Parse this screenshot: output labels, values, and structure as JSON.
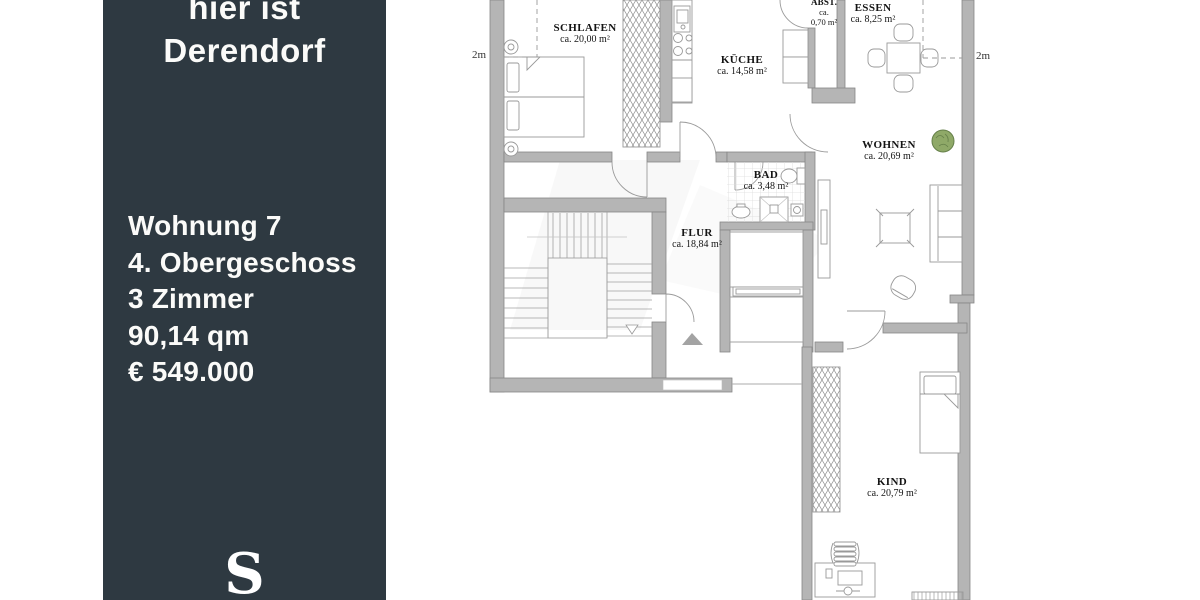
{
  "sidebar": {
    "background_color": "#2e3941",
    "text_color": "#fbfbf9",
    "tagline_line1": "hier ist",
    "tagline_line2": "Derendorf",
    "details": {
      "unit": "Wohnung 7",
      "floor": "4. Obergeschoss",
      "rooms_count": "3 Zimmer",
      "living_space": "90,14 qm",
      "price": "€ 549.000"
    },
    "logo_letter": "S"
  },
  "floorplan": {
    "rooms": [
      {
        "name": "SCHLAFEN",
        "area": "ca. 20,00 m²"
      },
      {
        "name": "KÜCHE",
        "area": "ca. 14,58 m²"
      },
      {
        "name": "ABST.",
        "area_line1": "ca.",
        "area_line2": "0,70 m²"
      },
      {
        "name": "ESSEN",
        "area": "ca. 8,25 m²"
      },
      {
        "name": "WOHNEN",
        "area": "ca. 20,69 m²"
      },
      {
        "name": "BAD",
        "area": "ca. 3,48 m²"
      },
      {
        "name": "FLUR",
        "area": "ca. 18,84 m²"
      },
      {
        "name": "KIND",
        "area": "ca. 20,79 m²"
      }
    ],
    "dimensions": {
      "left_top": "3m",
      "left_mid": "2m",
      "right_top": "3m",
      "right_mid": "2m"
    },
    "colors": {
      "wall_fill": "#b5b5b5",
      "wall_stroke": "#878787",
      "furniture_stroke": "#999999",
      "plant_fill": "#8fa968",
      "plant_stroke": "#66804a"
    }
  }
}
